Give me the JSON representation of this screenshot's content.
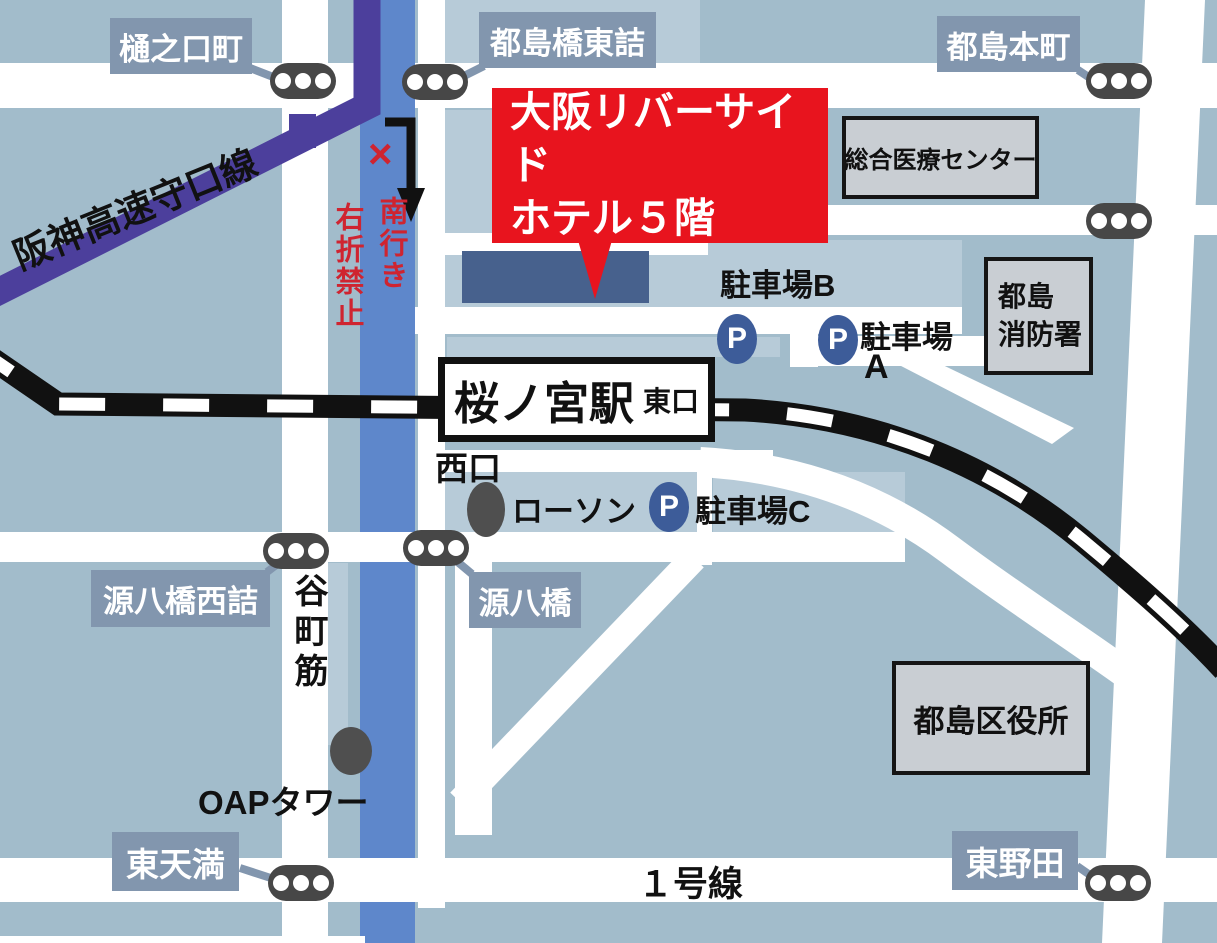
{
  "callout": {
    "line1": "大阪リバーサイド",
    "line2": "ホテル５階"
  },
  "station": {
    "name": "桜ノ宮駅",
    "east_exit": "東口",
    "west_exit": "西口"
  },
  "area_labels": {
    "hinokuchicho": "樋之口町",
    "miyakojimabashi_higashizume": "都島橋東詰",
    "miyakojima_honmachi": "都島本町",
    "genpachibashi_nishizume": "源八橋西詰",
    "genpachibashi": "源八橋",
    "higashi_tenma": "東天満",
    "higashi_noda": "東野田"
  },
  "buildings": {
    "medical_center": "総合医療センター",
    "fire_station_line1": "都島",
    "fire_station_line2": "消防署",
    "ward_office": "都島区役所"
  },
  "roads": {
    "hanshin_expressway": "阪神高速守口線",
    "tanimachi_suji": "谷町筋",
    "route_1": "１号線"
  },
  "warning": {
    "mark": "×",
    "line1": "南行き",
    "line2": "右折禁止"
  },
  "pois": {
    "lawson": "ローソン",
    "oap_tower": "OAPタワー",
    "parking_b": "駐車場B",
    "parking_a_word": "駐車場",
    "parking_a_letter": "A",
    "parking_c": "駐車場C",
    "p_icon_letter": "P"
  },
  "colors": {
    "background": "#a2bccb",
    "city_block": "#b7cbd8",
    "road_white": "#ffffff",
    "river_blue": "#5e87cb",
    "expressway_purple": "#4c3f9c",
    "railway_black": "#111111",
    "callout_red": "#e8141e",
    "warning_red": "#cf2430",
    "label_slate": "#8296ae",
    "building_gray": "#c9ced3",
    "parking_blue": "#3d5c99",
    "traffic_light_gray": "#474747",
    "hotel_navy": "#47618d"
  }
}
